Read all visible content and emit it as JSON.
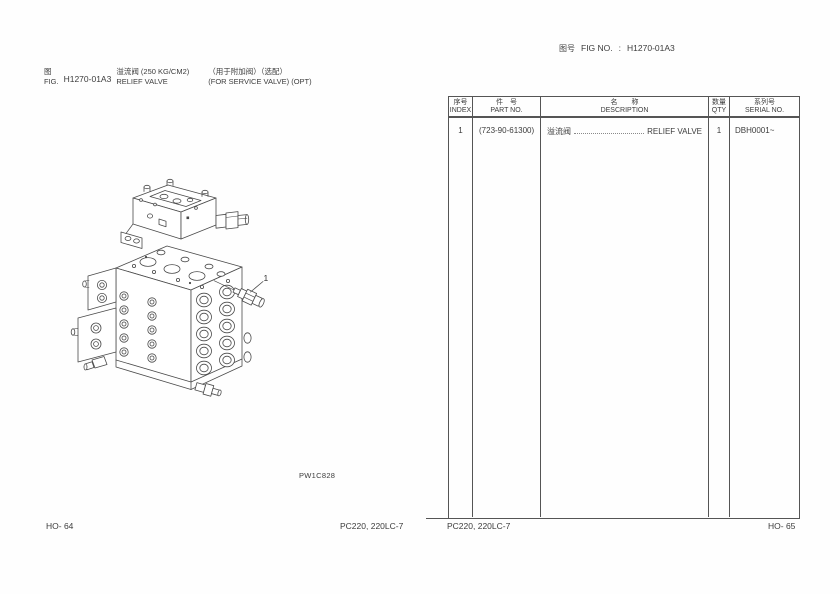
{
  "header": {
    "fig_label_cjk": "图号",
    "fig_label_en": "FIG NO.",
    "colon": ":",
    "fig_no": "H1270-01A3"
  },
  "title": {
    "fig_cjk": "图",
    "fig_en": "FIG.",
    "fig_no": "H1270-01A3",
    "name_cjk": "溢流阀 (250 KG/CM2)",
    "name_en": "RELIEF VALVE",
    "opt_cjk": "（用于附加阀）（选配）",
    "opt_en": "(FOR SERVICE VALVE) (OPT)"
  },
  "drawing": {
    "code": "PW1C828",
    "callout": "1"
  },
  "table": {
    "headers": [
      {
        "cjk": "序号",
        "en": "INDEX"
      },
      {
        "cjk": "件　号",
        "en": "PART NO."
      },
      {
        "cjk": "名　　称",
        "en": "DESCRIPTION"
      },
      {
        "cjk": "数量",
        "en": "QTY"
      },
      {
        "cjk": "系列号",
        "en": "SERIAL NO."
      }
    ],
    "rows": [
      {
        "index": "1",
        "part_no": "(723-90-61300)",
        "desc_cjk": "溢流阀",
        "desc_en": "RELIEF VALVE",
        "qty": "1",
        "serial": "DBH0001~"
      }
    ]
  },
  "footer": {
    "left_page": "HO- 64",
    "left_model": "PC220, 220LC-7",
    "right_model": "PC220, 220LC-7",
    "right_page": "HO- 65"
  },
  "colors": {
    "line_art": "#4a4a4a",
    "table_border": "#555555",
    "text": "#3c3c3c"
  }
}
